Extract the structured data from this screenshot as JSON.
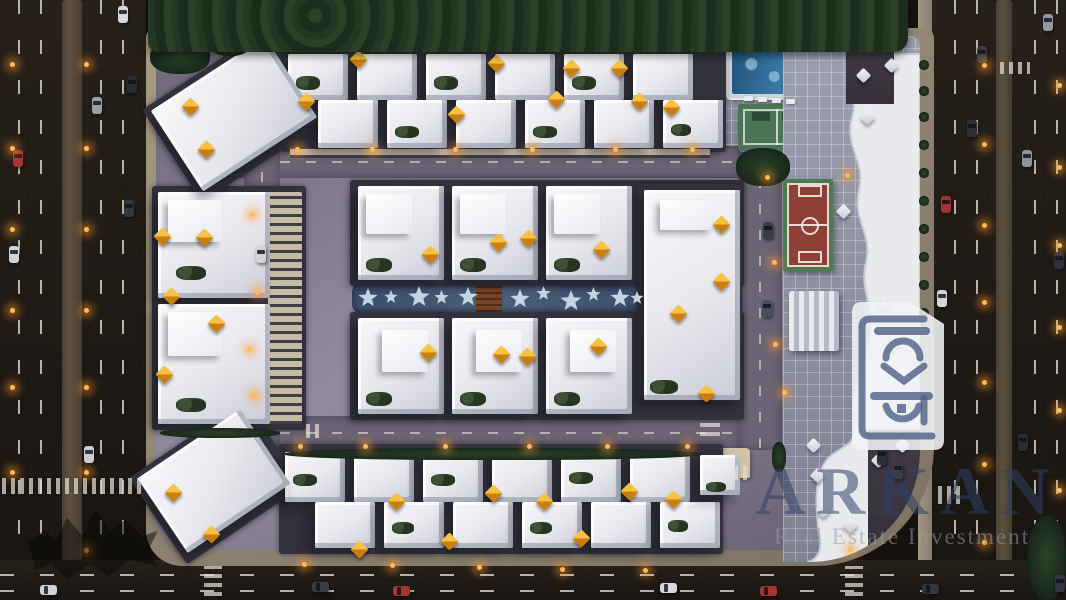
{
  "watermark": {
    "brand": "ARKAN",
    "tagline": "Real Estate Investment"
  },
  "colors": {
    "umbrella_orange": "#E89A15",
    "watermark_navy": "#2F4066",
    "tagline_gray": "#969AA3",
    "pool_blue": "#2D6B96",
    "court_red": "#8E4036",
    "court_green": "#4E7A50",
    "pavement_purple": "#867F92",
    "asphalt": "#201B16",
    "building_white": "#EFEFF3",
    "lamp_glow": "#FF9828"
  },
  "scene": {
    "gaps": [
      [
        282,
        46,
        444,
        106,
        0
      ],
      [
        279,
        444,
        444,
        110,
        0
      ],
      [
        350,
        180,
        394,
        106,
        0
      ],
      [
        350,
        312,
        394,
        108,
        0
      ],
      [
        638,
        184,
        104,
        218,
        0
      ],
      [
        152,
        186,
        154,
        244,
        0
      ],
      [
        160,
        60,
        150,
        110,
        -33
      ],
      [
        146,
        430,
        140,
        104,
        -34
      ],
      [
        644,
        242,
        96,
        5,
        0
      ],
      [
        644,
        296,
        96,
        5,
        0
      ],
      [
        644,
        350,
        96,
        5,
        0
      ]
    ],
    "villas": [
      [
        288,
        54,
        60,
        46,
        0
      ],
      [
        357,
        54,
        60,
        46,
        0
      ],
      [
        426,
        54,
        60,
        46,
        0
      ],
      [
        495,
        54,
        60,
        46,
        0
      ],
      [
        564,
        54,
        60,
        46,
        0
      ],
      [
        633,
        54,
        60,
        46,
        0
      ],
      [
        318,
        100,
        60,
        48,
        0
      ],
      [
        387,
        100,
        60,
        48,
        0
      ],
      [
        456,
        100,
        60,
        48,
        0
      ],
      [
        525,
        100,
        60,
        48,
        0
      ],
      [
        594,
        100,
        60,
        48,
        0
      ],
      [
        663,
        100,
        60,
        48,
        0
      ],
      [
        285,
        452,
        60,
        50,
        0
      ],
      [
        354,
        452,
        60,
        50,
        0
      ],
      [
        423,
        452,
        60,
        50,
        0
      ],
      [
        492,
        452,
        60,
        50,
        0
      ],
      [
        561,
        452,
        60,
        50,
        0
      ],
      [
        630,
        452,
        60,
        50,
        0
      ],
      [
        315,
        502,
        60,
        46,
        0
      ],
      [
        384,
        502,
        60,
        46,
        0
      ],
      [
        453,
        502,
        60,
        46,
        0
      ],
      [
        522,
        502,
        60,
        46,
        0
      ],
      [
        591,
        502,
        60,
        46,
        0
      ],
      [
        660,
        502,
        60,
        46,
        0
      ],
      [
        358,
        186,
        86,
        94,
        0
      ],
      [
        452,
        186,
        86,
        94,
        0
      ],
      [
        546,
        186,
        86,
        94,
        0
      ],
      [
        358,
        318,
        86,
        96,
        0
      ],
      [
        452,
        318,
        86,
        96,
        0
      ],
      [
        546,
        318,
        86,
        96,
        0
      ],
      [
        644,
        190,
        96,
        210,
        0
      ],
      [
        158,
        192,
        112,
        106,
        0
      ],
      [
        158,
        304,
        112,
        120,
        0
      ],
      [
        166,
        66,
        136,
        96,
        -33
      ],
      [
        152,
        436,
        124,
        90,
        -34
      ],
      [
        700,
        455,
        40,
        40,
        0
      ]
    ],
    "roofblocks": [
      [
        366,
        194,
        46,
        40
      ],
      [
        460,
        194,
        46,
        40
      ],
      [
        554,
        194,
        46,
        40
      ],
      [
        382,
        330,
        46,
        42
      ],
      [
        476,
        330,
        46,
        42
      ],
      [
        570,
        330,
        46,
        42
      ],
      [
        660,
        200,
        52,
        30
      ],
      [
        168,
        200,
        54,
        42
      ],
      [
        168,
        312,
        54,
        44
      ]
    ],
    "facades": [
      [
        268,
        192,
        34,
        232
      ],
      [
        290,
        148,
        420,
        10
      ]
    ],
    "gardens": [
      [
        296,
        76,
        24,
        14
      ],
      [
        434,
        76,
        24,
        14
      ],
      [
        572,
        76,
        24,
        14
      ],
      [
        395,
        126,
        24,
        12
      ],
      [
        533,
        126,
        24,
        12
      ],
      [
        671,
        124,
        20,
        12
      ],
      [
        293,
        474,
        24,
        12
      ],
      [
        431,
        474,
        24,
        12
      ],
      [
        569,
        472,
        24,
        12
      ],
      [
        392,
        522,
        22,
        12
      ],
      [
        530,
        522,
        22,
        12
      ],
      [
        668,
        520,
        20,
        12
      ],
      [
        366,
        258,
        26,
        14
      ],
      [
        460,
        258,
        26,
        14
      ],
      [
        554,
        258,
        26,
        14
      ],
      [
        366,
        392,
        26,
        14
      ],
      [
        460,
        392,
        26,
        14
      ],
      [
        554,
        392,
        26,
        14
      ],
      [
        650,
        380,
        28,
        14
      ],
      [
        176,
        266,
        30,
        14
      ],
      [
        176,
        398,
        30,
        14
      ],
      [
        706,
        482,
        20,
        10
      ]
    ],
    "bushes": [
      [
        285,
        448,
        416,
        12
      ],
      [
        160,
        428,
        120,
        10
      ],
      [
        736,
        148,
        54,
        38
      ],
      [
        1028,
        516,
        38,
        84
      ],
      [
        150,
        40,
        60,
        34
      ],
      [
        210,
        34,
        40,
        22
      ],
      [
        772,
        442,
        14,
        30
      ],
      [
        919,
        60,
        10,
        10
      ],
      [
        919,
        86,
        10,
        10
      ],
      [
        919,
        112,
        10,
        10
      ],
      [
        919,
        140,
        10,
        10
      ],
      [
        919,
        168,
        10,
        10
      ],
      [
        919,
        196,
        10,
        10
      ],
      [
        919,
        224,
        10,
        10
      ],
      [
        919,
        252,
        10,
        10
      ],
      [
        919,
        280,
        10,
        10
      ],
      [
        919,
        308,
        10,
        10
      ]
    ],
    "stars": [
      [
        358,
        288,
        20
      ],
      [
        384,
        290,
        14
      ],
      [
        408,
        286,
        22
      ],
      [
        434,
        290,
        15
      ],
      [
        458,
        287,
        20
      ],
      [
        510,
        289,
        20
      ],
      [
        536,
        286,
        15
      ],
      [
        560,
        290,
        22
      ],
      [
        586,
        287,
        15
      ],
      [
        610,
        288,
        20
      ],
      [
        630,
        291,
        14
      ]
    ],
    "umbrellas": [
      [
        352,
        53
      ],
      [
        490,
        57
      ],
      [
        565,
        62
      ],
      [
        613,
        62
      ],
      [
        300,
        95
      ],
      [
        450,
        108
      ],
      [
        550,
        93
      ],
      [
        633,
        95
      ],
      [
        665,
        101
      ],
      [
        184,
        100
      ],
      [
        200,
        143
      ],
      [
        156,
        230
      ],
      [
        198,
        231
      ],
      [
        165,
        290
      ],
      [
        210,
        317
      ],
      [
        158,
        368
      ],
      [
        167,
        486
      ],
      [
        205,
        528
      ],
      [
        353,
        543
      ],
      [
        390,
        495
      ],
      [
        443,
        535
      ],
      [
        487,
        487
      ],
      [
        538,
        495
      ],
      [
        575,
        532
      ],
      [
        623,
        485
      ],
      [
        667,
        493
      ],
      [
        424,
        248
      ],
      [
        492,
        236
      ],
      [
        522,
        232
      ],
      [
        595,
        243
      ],
      [
        422,
        346
      ],
      [
        495,
        348
      ],
      [
        521,
        350
      ],
      [
        592,
        340
      ],
      [
        715,
        218
      ],
      [
        715,
        275
      ],
      [
        672,
        307
      ],
      [
        700,
        387
      ]
    ],
    "parasols": [
      [
        858,
        70
      ],
      [
        862,
        112
      ],
      [
        886,
        60
      ],
      [
        838,
        206
      ],
      [
        878,
        298
      ],
      [
        888,
        338
      ],
      [
        873,
        455
      ],
      [
        897,
        440
      ],
      [
        845,
        520
      ],
      [
        808,
        440
      ],
      [
        812,
        470
      ],
      [
        818,
        505
      ]
    ],
    "loungers": [
      [
        744,
        96
      ],
      [
        758,
        97
      ],
      [
        772,
        98
      ],
      [
        786,
        99
      ]
    ],
    "lights": [
      [
        10,
        62
      ],
      [
        10,
        146
      ],
      [
        10,
        227
      ],
      [
        10,
        308
      ],
      [
        10,
        385
      ],
      [
        10,
        470
      ],
      [
        84,
        62
      ],
      [
        84,
        146
      ],
      [
        84,
        227
      ],
      [
        84,
        308
      ],
      [
        84,
        385
      ],
      [
        84,
        470
      ],
      [
        84,
        548
      ],
      [
        982,
        63
      ],
      [
        982,
        142
      ],
      [
        982,
        223
      ],
      [
        982,
        300
      ],
      [
        982,
        380
      ],
      [
        982,
        462
      ],
      [
        982,
        540
      ],
      [
        1057,
        83
      ],
      [
        1057,
        165
      ],
      [
        1057,
        243
      ],
      [
        1057,
        325
      ],
      [
        1057,
        408
      ],
      [
        1057,
        488
      ],
      [
        295,
        147
      ],
      [
        370,
        147
      ],
      [
        453,
        147
      ],
      [
        530,
        147
      ],
      [
        613,
        147
      ],
      [
        690,
        147
      ],
      [
        298,
        444
      ],
      [
        363,
        444
      ],
      [
        443,
        444
      ],
      [
        527,
        444
      ],
      [
        605,
        444
      ],
      [
        685,
        444
      ],
      [
        250,
        212
      ],
      [
        255,
        290
      ],
      [
        247,
        347
      ],
      [
        252,
        393
      ],
      [
        765,
        175
      ],
      [
        772,
        260
      ],
      [
        773,
        342
      ],
      [
        782,
        390
      ],
      [
        845,
        173
      ],
      [
        848,
        547
      ],
      [
        302,
        562
      ],
      [
        390,
        563
      ],
      [
        477,
        565
      ],
      [
        560,
        567
      ],
      [
        643,
        568
      ]
    ],
    "cars": [
      [
        118,
        6,
        "#d8d8dc",
        "v"
      ],
      [
        127,
        76,
        "#2b2d34",
        "v"
      ],
      [
        92,
        97,
        "#9aa0aa",
        "v"
      ],
      [
        13,
        150,
        "#a83430",
        "v"
      ],
      [
        124,
        200,
        "#35373f",
        "v"
      ],
      [
        9,
        246,
        "#d3d4d8",
        "v"
      ],
      [
        84,
        446,
        "#c9ccd2",
        "v"
      ],
      [
        967,
        120,
        "#2f3138",
        "v"
      ],
      [
        1022,
        150,
        "#8f929c",
        "v"
      ],
      [
        941,
        196,
        "#a2342c",
        "v"
      ],
      [
        1054,
        252,
        "#2f3138",
        "v"
      ],
      [
        937,
        290,
        "#d5d6da",
        "v"
      ],
      [
        1018,
        434,
        "#2b2d34",
        "v"
      ],
      [
        977,
        46,
        "#3c3e46",
        "v"
      ],
      [
        1043,
        14,
        "#94969e",
        "v"
      ],
      [
        1055,
        575,
        "#33363e",
        "v"
      ],
      [
        256,
        246,
        "#d2d3d7",
        "v"
      ],
      [
        763,
        222,
        "#3a3d45",
        "v"
      ],
      [
        762,
        300,
        "#4a4e5c",
        "v"
      ],
      [
        877,
        448,
        "#2b2e36",
        "v"
      ],
      [
        893,
        462,
        "#3a3d46",
        "v"
      ],
      [
        312,
        582,
        "#3a3d46",
        "h"
      ],
      [
        393,
        586,
        "#a83430",
        "h"
      ],
      [
        660,
        583,
        "#d8d8dc",
        "h"
      ],
      [
        760,
        586,
        "#a83430",
        "h"
      ],
      [
        922,
        584,
        "#33363e",
        "h"
      ],
      [
        40,
        585,
        "#cfd1d6",
        "h"
      ]
    ],
    "crosswalks": [
      [
        2,
        478,
        142,
        16,
        "v"
      ],
      [
        204,
        566,
        18,
        30,
        "h"
      ],
      [
        845,
        566,
        18,
        30,
        "h"
      ],
      [
        1000,
        62,
        30,
        12,
        "v"
      ],
      [
        938,
        486,
        26,
        18,
        "v"
      ],
      [
        306,
        424,
        18,
        14,
        "v"
      ],
      [
        700,
        420,
        20,
        16,
        "h"
      ],
      [
        734,
        466,
        18,
        14,
        "v"
      ]
    ]
  }
}
